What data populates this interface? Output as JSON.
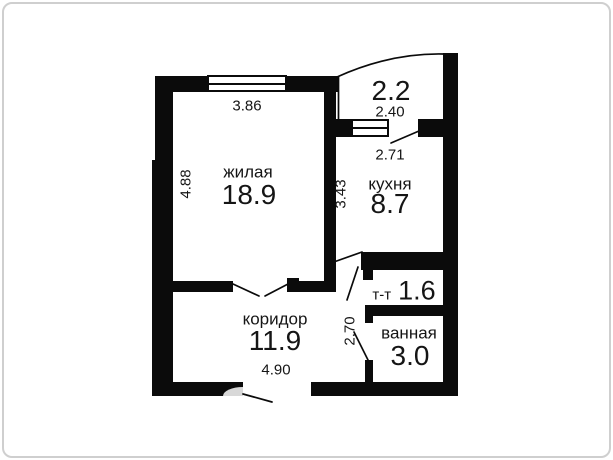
{
  "colors": {
    "wall": "#0b0b0b",
    "text": "#151515",
    "door_arc": "#d8d8d8",
    "frame_border": "#cfcfcf",
    "background": "#ffffff"
  },
  "rooms": {
    "living": {
      "label": "жилая",
      "area": "18.9",
      "dim_width": "3.86",
      "dim_height": "4.88"
    },
    "kitchen": {
      "label": "кухня",
      "area": "8.7",
      "dim_width": "2.71",
      "dim_height": "3.43"
    },
    "balcony": {
      "area": "2.2",
      "dim_width": "2.40"
    },
    "corridor": {
      "label": "коридор",
      "area": "11.9",
      "dim_width": "4.90",
      "dim_height": "2.70"
    },
    "toilet": {
      "label": "т-т",
      "area": "1.6"
    },
    "bathroom": {
      "label": "ванная",
      "area": "3.0"
    }
  }
}
